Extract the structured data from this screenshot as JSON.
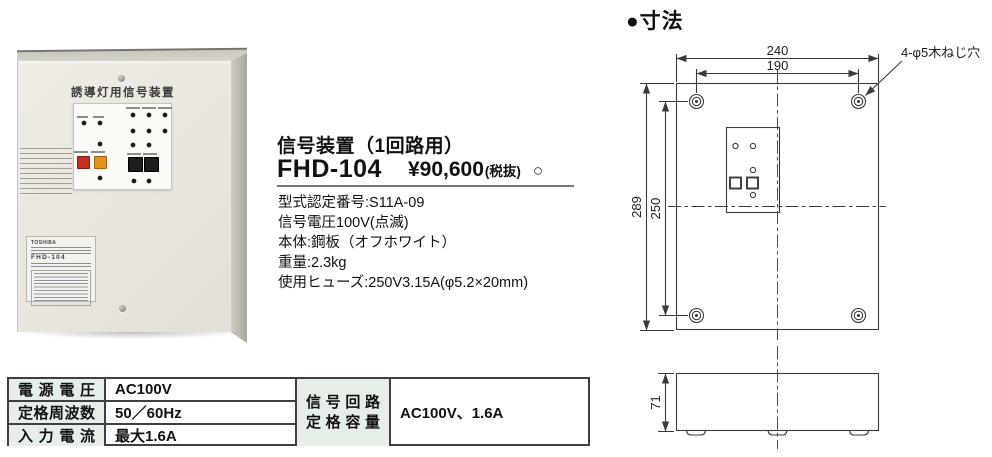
{
  "photo": {
    "panel_title": "誘導灯用信号装置",
    "label_brand": "TOSHIBA",
    "label_model": "FHD-104"
  },
  "info": {
    "title": "信号装置（1回路用）",
    "model": "FHD-104",
    "price": "¥90,600",
    "tax_note": "(税抜)",
    "price_marker": "○",
    "spec_lines": [
      "型式認定番号:S11A-09",
      "信号電圧100V(点滅)",
      "本体:鋼板（オフホワイト）",
      "重量:2.3kg",
      "使用ヒューズ:250V3.15A(φ5.2×20mm)"
    ]
  },
  "spec_table": {
    "header_bg": "#e5efe7",
    "rows": [
      {
        "label": "電源電圧",
        "value": "AC100V"
      },
      {
        "label": "定格周波数",
        "value": "50／60Hz"
      },
      {
        "label": "入力電流",
        "value": "最大1.6A"
      }
    ],
    "merged_label_line1": "信号回路",
    "merged_label_line2": "定格容量",
    "merged_value": "AC100V、1.6A"
  },
  "dims": {
    "title": "●寸法",
    "w_outer": "240",
    "w_holes": "190",
    "h_outer": "289",
    "h_holes": "250",
    "depth": "71",
    "hole_note": "4-φ5木ねじ穴"
  }
}
